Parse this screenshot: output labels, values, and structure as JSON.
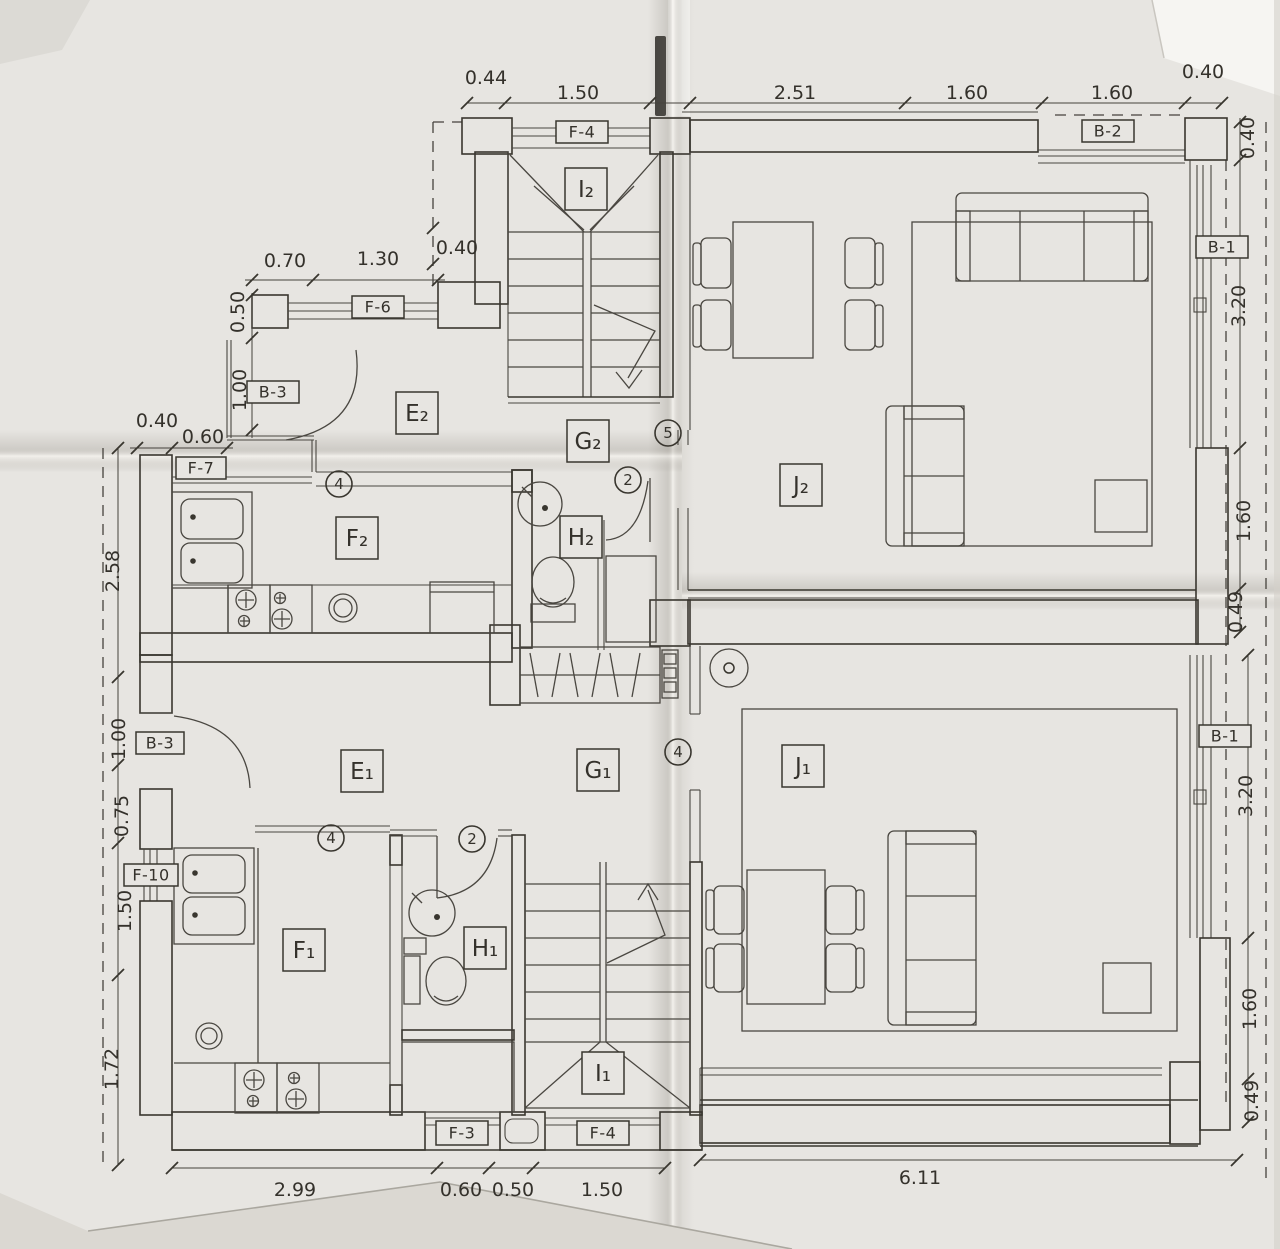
{
  "colors": {
    "paper": "#e7e5e1",
    "ink": "#39362f"
  },
  "rooms": [
    {
      "label": "I₂"
    },
    {
      "label": "E₂"
    },
    {
      "label": "G₂"
    },
    {
      "label": "F₂"
    },
    {
      "label": "H₂"
    },
    {
      "label": "J₂"
    },
    {
      "label": "E₁"
    },
    {
      "label": "G₁"
    },
    {
      "label": "F₁"
    },
    {
      "label": "H₁"
    },
    {
      "label": "I₁"
    },
    {
      "label": "J₁"
    }
  ],
  "codes": [
    {
      "code": "F-4"
    },
    {
      "code": "B-2"
    },
    {
      "code": "F-6"
    },
    {
      "code": "B-3"
    },
    {
      "code": "F-7"
    },
    {
      "code": "B-1"
    },
    {
      "code": "B-3"
    },
    {
      "code": "F-10"
    },
    {
      "code": "B-1"
    },
    {
      "code": "F-3"
    },
    {
      "code": "F-4"
    }
  ],
  "notes": [
    {
      "n": "4"
    },
    {
      "n": "2"
    },
    {
      "n": "5"
    },
    {
      "n": "4"
    },
    {
      "n": "2"
    },
    {
      "n": "4"
    }
  ],
  "dims": {
    "top": [
      "0.44",
      "1.50",
      "2.51",
      "1.60",
      "1.60",
      "0.40"
    ],
    "right_upper": [
      "0.40",
      "3.20",
      "1.60",
      "0.49"
    ],
    "right_lower": [
      "3.20",
      "1.60",
      "0.49"
    ],
    "left_upper": [
      "0.40",
      "0.70",
      "1.30",
      "0.50",
      "1.00",
      "0.40",
      "0.60"
    ],
    "left_lower": [
      "2.58",
      "1.00",
      "0.75",
      "1.50",
      "1.72"
    ],
    "bottom": [
      "2.99",
      "0.60",
      "0.50",
      "1.50",
      "6.11"
    ]
  }
}
